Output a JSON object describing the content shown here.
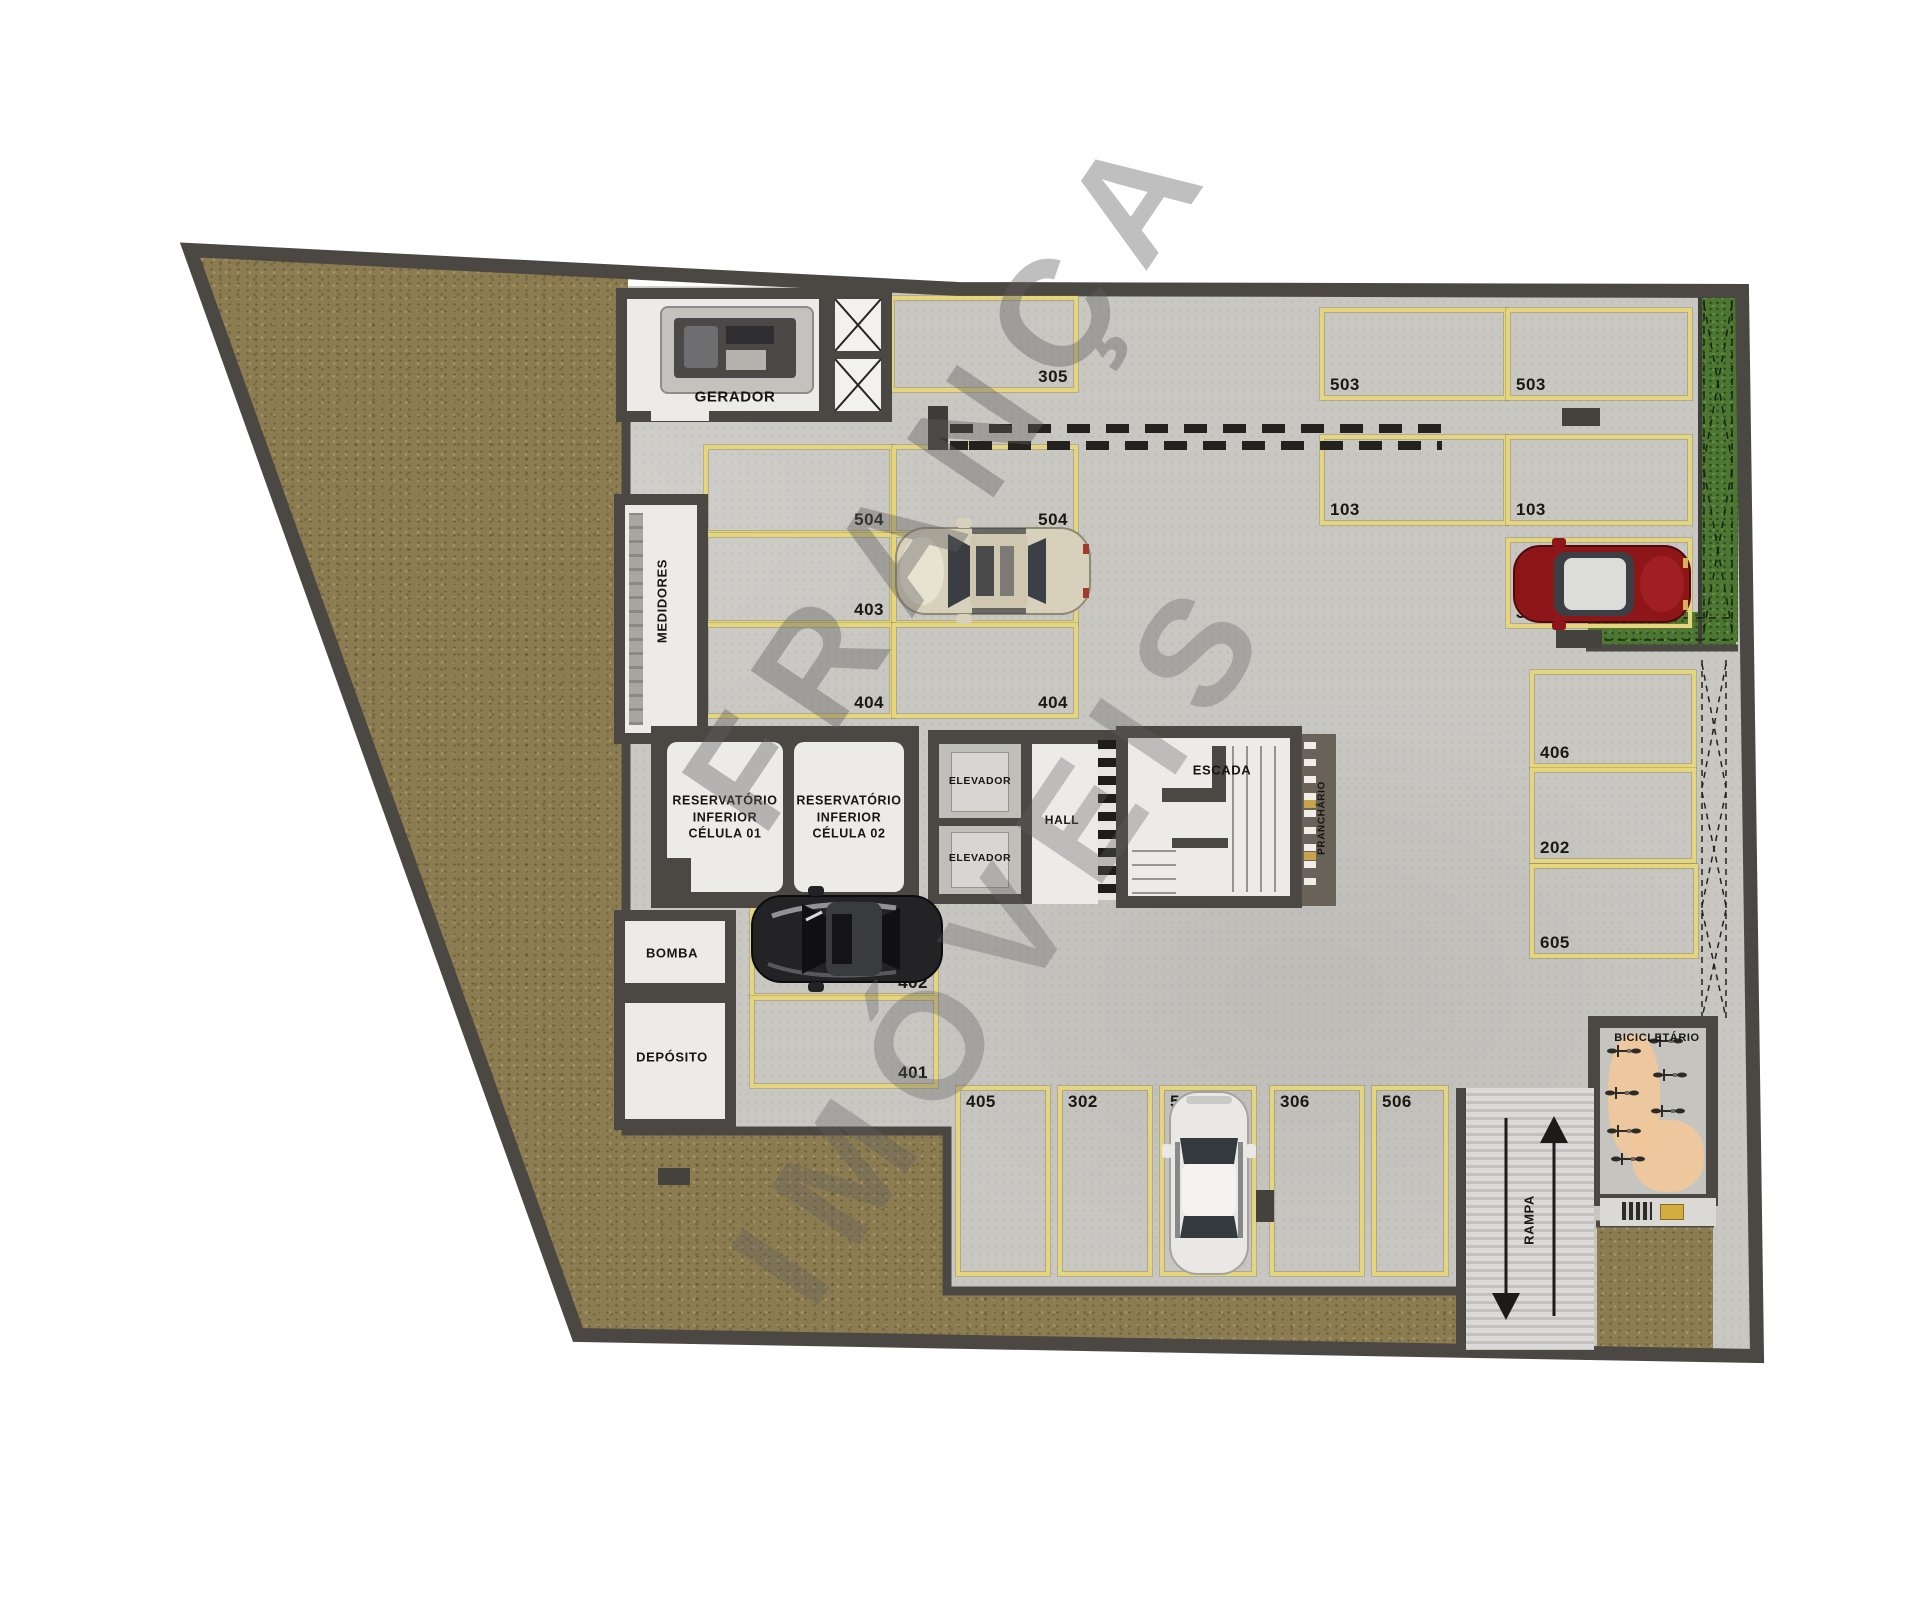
{
  "watermark": {
    "line1": "FRANÇA",
    "line2": "IMÓVEIS"
  },
  "rooms": {
    "gerador": "GERADOR",
    "medidores": "MEDIDORES",
    "bomba": "BOMBA",
    "deposito": "DEPÓSITO",
    "reservatorio_line1": "RESERVATÓRIO",
    "reservatorio_line2": "INFERIOR",
    "reservatorio1_cell": "CÉLULA 01",
    "reservatorio2_cell": "CÉLULA 02",
    "elevador": "ELEVADOR",
    "hall": "HALL",
    "escada": "ESCADA",
    "prancheario": "PRANCHÁRIO",
    "bicicletario": "BICICLETÁRIO",
    "rampa": "RAMPA"
  },
  "parking": {
    "spots": [
      {
        "id": "305"
      },
      {
        "id": "503"
      },
      {
        "id": "503"
      },
      {
        "id": "103"
      },
      {
        "id": "103"
      },
      {
        "id": "301"
      },
      {
        "id": "406"
      },
      {
        "id": "202"
      },
      {
        "id": "605"
      },
      {
        "id": "504"
      },
      {
        "id": "504"
      },
      {
        "id": "403"
      },
      {
        "id": "403"
      },
      {
        "id": "404"
      },
      {
        "id": "404"
      },
      {
        "id": "402"
      },
      {
        "id": "401"
      },
      {
        "id": "405"
      },
      {
        "id": "302"
      },
      {
        "id": "501"
      },
      {
        "id": "306"
      },
      {
        "id": "506"
      }
    ]
  },
  "colors": {
    "wall": "#4b4742",
    "floor": "#c9c7c2",
    "terrain": "#8c7c51",
    "hedge": "#4c7632",
    "parking_line": "#e5d67e",
    "bike_path": "#efc79b",
    "car_red": "#8e1518",
    "car_beige": "#d7d0bb",
    "car_dark": "#232326",
    "car_white": "#e9e8e5"
  }
}
